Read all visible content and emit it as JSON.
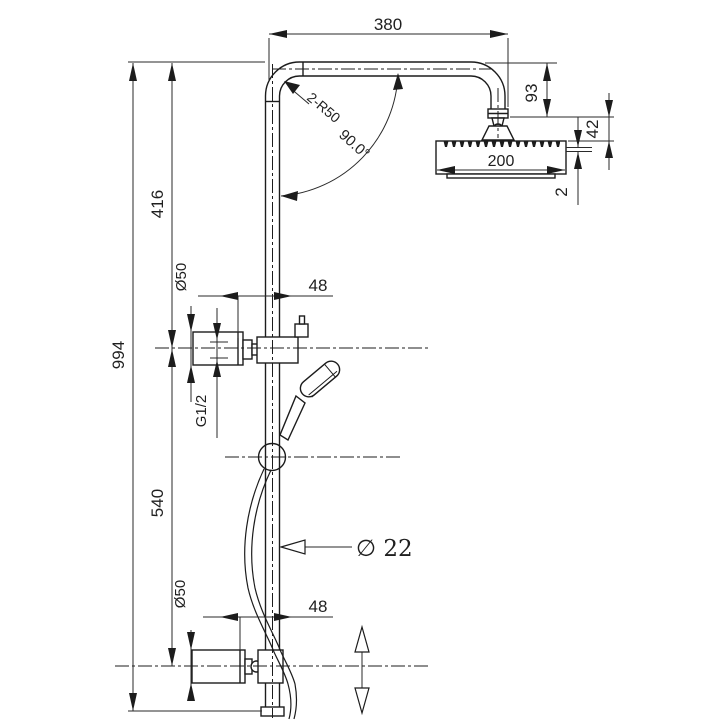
{
  "drawing": {
    "background_color": "#ffffff",
    "line_color": "#1c1c1c",
    "labels": {
      "total_width": "380",
      "arm_drop_height": "93",
      "head_to_arm_offset": "42",
      "spray_plate_thickness": "2",
      "head_width": "200",
      "bend_radius_note": "2-R50",
      "bend_angle": "90.0°",
      "upper_height": "416",
      "total_height": "994",
      "lower_height": "540",
      "upper_bracket_diameter": "Ø50",
      "upper_bracket_offset": "48",
      "thread_size": "G1/2",
      "pipe_diameter": "∅ 22",
      "lower_bracket_offset": "48",
      "lower_bracket_diameter": "Ø50"
    }
  }
}
